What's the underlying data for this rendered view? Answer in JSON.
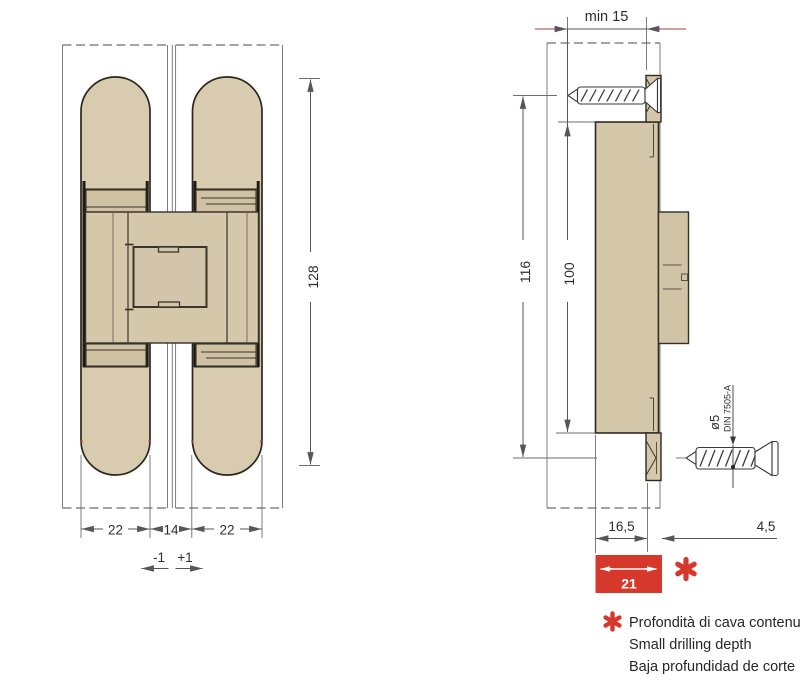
{
  "front_view": {
    "left_leaf_width": "22",
    "center_gap": "14",
    "right_leaf_width": "22",
    "tolerance_minus": "-1",
    "tolerance_plus": "+1",
    "total_length": "128"
  },
  "side_view": {
    "min_clearance": "min 15",
    "overall_height": "116",
    "body_height": "100",
    "body_depth": "16,5",
    "plate_depth": "4,5",
    "drilling_depth": "21",
    "screw_diameter": "ø5",
    "screw_standard": "DIN 7505-A"
  },
  "footnote": {
    "marker": "*",
    "line_italian": "Profondità di cava contenu",
    "line_english": "Small drilling depth",
    "line_spanish": "Baja profundidad de corte"
  },
  "colors": {
    "hinge_fill": "#d5c7aa",
    "hinge_fill_light": "#d8cbb0",
    "hinge_fill_dark": "#cfc1a2",
    "outline": "#2c2820",
    "dimension": "#55555a",
    "accent_red": "#d6382c"
  }
}
